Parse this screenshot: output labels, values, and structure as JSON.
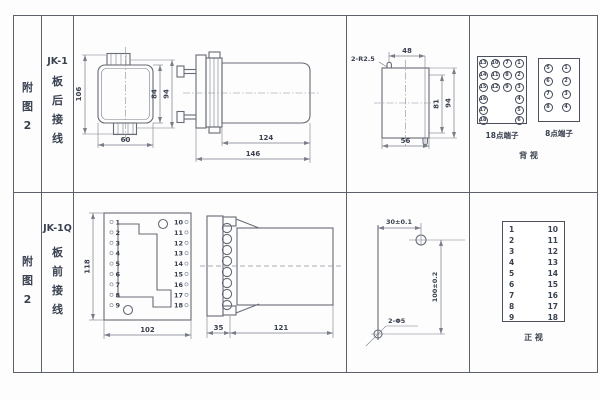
{
  "row1": {
    "fig_label": [
      "附",
      "图",
      "2"
    ],
    "model": "JK-1",
    "wiring": [
      "板",
      "后",
      "接",
      "线"
    ],
    "rear_view": {
      "dim_height_total": "106",
      "dim_height_inner": "84",
      "dim_height_outer": "94",
      "dim_width": "60"
    },
    "side_view": {
      "dim_body": "124",
      "dim_total": "146"
    },
    "cutout": {
      "radius_label": "2-R2.5",
      "dim_top_width": "48",
      "dim_height_inner": "81",
      "dim_height_total": "94",
      "dim_bottom_width": "56"
    },
    "back_view": {
      "caption": "背  视",
      "p18": {
        "caption": "18点端子",
        "rows": [
          [
            "13",
            "10",
            "7",
            "1"
          ],
          [
            "14",
            "11",
            "8",
            "2"
          ],
          [
            "15",
            "12",
            "9",
            "3"
          ],
          [
            "16",
            "4"
          ],
          [
            "17",
            "5"
          ],
          [
            "18",
            "6"
          ]
        ]
      },
      "p8": {
        "caption": "8点端子",
        "rows": [
          [
            "5",
            "1"
          ],
          [
            "6",
            "2"
          ],
          [
            "7",
            "3"
          ],
          [
            "8",
            "4"
          ]
        ]
      }
    }
  },
  "row2": {
    "fig_label": [
      "附",
      "图",
      "2"
    ],
    "model": "JK-1Q",
    "wiring": [
      "板",
      "前",
      "接",
      "线"
    ],
    "front_view": {
      "dim_height": "118",
      "dim_width": "102",
      "left_terminals": [
        "1",
        "2",
        "3",
        "4",
        "5",
        "6",
        "7",
        "8",
        "9"
      ],
      "right_terminals": [
        "10",
        "11",
        "12",
        "13",
        "14",
        "15",
        "16",
        "17",
        "18"
      ]
    },
    "side_view": {
      "dim_plate": "35",
      "dim_body": "121"
    },
    "drill": {
      "dim_horizontal": "30±0.1",
      "dim_vertical": "100±0.2",
      "hole_label": "2-Φ5"
    },
    "front_panel": {
      "caption": "正  视",
      "left": [
        "1",
        "2",
        "3",
        "4",
        "5",
        "6",
        "7",
        "8",
        "9"
      ],
      "right": [
        "10",
        "11",
        "12",
        "13",
        "14",
        "15",
        "16",
        "17",
        "18"
      ]
    }
  }
}
